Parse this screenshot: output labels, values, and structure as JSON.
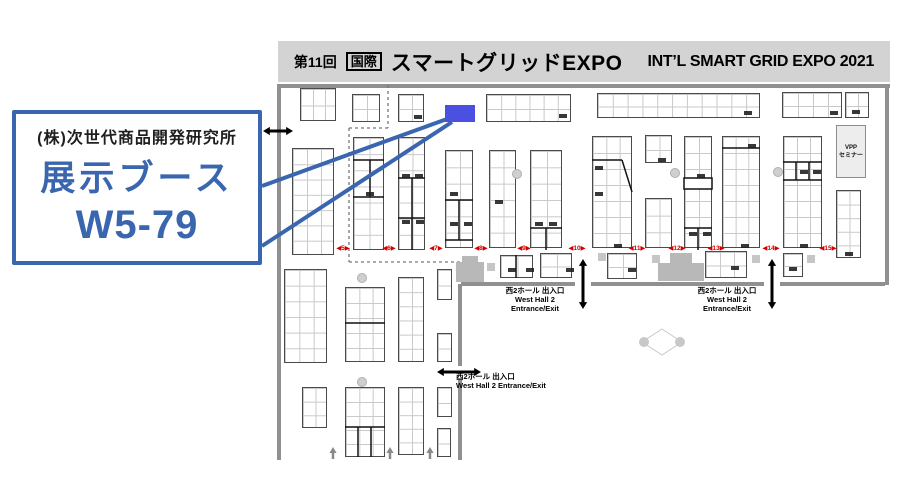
{
  "header": {
    "edition": "第11回",
    "kokusai": "国際",
    "title_jp": "スマートグリッドEXPO",
    "title_en": "INT’L SMART GRID EXPO 2021"
  },
  "callout": {
    "company": "(株)次世代商品開発研究所",
    "line1": "展示ブース",
    "booth_no": "W5-79",
    "accent": "#3a66b0"
  },
  "map": {
    "highlight_booth": {
      "name": "W5-79",
      "x": 445,
      "y": 105,
      "w": 30,
      "h": 17,
      "color": "#4b50e0"
    },
    "connector_color": "#3a66b0",
    "connectors": [
      [
        262,
        186,
        447,
        119
      ],
      [
        262,
        246,
        452,
        122
      ]
    ],
    "seminar_box": {
      "x": 836,
      "y": 125,
      "w": 30,
      "h": 53,
      "lines": [
        "VPP",
        "セミナー"
      ]
    },
    "entrances": [
      {
        "x": 493,
        "y": 286,
        "w": 84,
        "align": "center",
        "lines": [
          "西2ホール 出入口",
          "West Hall 2",
          "Entrance/Exit"
        ]
      },
      {
        "x": 685,
        "y": 286,
        "w": 84,
        "align": "center",
        "lines": [
          "西2ホール 出入口",
          "West Hall 2",
          "Entrance/Exit"
        ]
      },
      {
        "x": 456,
        "y": 372,
        "w": 150,
        "align": "left",
        "lines": [
          "西2ホール 出入口",
          "West Hall 2 Entrance/Exit"
        ]
      }
    ],
    "aisles": {
      "y": 244,
      "color": "#d40000",
      "items": [
        {
          "label": "◀5▶",
          "x": 343
        },
        {
          "label": "◀6▶",
          "x": 389
        },
        {
          "label": "◀7▶",
          "x": 436
        },
        {
          "label": "◀8▶",
          "x": 481
        },
        {
          "label": "◀9▶",
          "x": 524
        },
        {
          "label": "◀10▶",
          "x": 577
        },
        {
          "label": "◀11▶",
          "x": 637
        },
        {
          "label": "◀12▶",
          "x": 677
        },
        {
          "label": "◀13▶",
          "x": 716
        },
        {
          "label": "◀14▶",
          "x": 771
        },
        {
          "label": "◀15▶",
          "x": 828
        }
      ]
    },
    "booths": [
      [
        300,
        88,
        36,
        33,
        3,
        2
      ],
      [
        352,
        94,
        28,
        28,
        2,
        2
      ],
      [
        398,
        94,
        26,
        28,
        2,
        2
      ],
      [
        486,
        94,
        85,
        28,
        6,
        2
      ],
      [
        597,
        93,
        163,
        25,
        11,
        2
      ],
      [
        782,
        92,
        60,
        26,
        4,
        2
      ],
      [
        845,
        92,
        24,
        26,
        2,
        2
      ],
      [
        292,
        148,
        42,
        107,
        3,
        7
      ],
      [
        353,
        137,
        31,
        113,
        2,
        7
      ],
      [
        398,
        137,
        27,
        113,
        2,
        7
      ],
      [
        445,
        150,
        28,
        98,
        2,
        6
      ],
      [
        489,
        150,
        27,
        98,
        2,
        6
      ],
      [
        530,
        150,
        32,
        98,
        2,
        6
      ],
      [
        592,
        136,
        40,
        112,
        3,
        7
      ],
      [
        645,
        135,
        27,
        28,
        2,
        2
      ],
      [
        645,
        198,
        27,
        50,
        2,
        3
      ],
      [
        684,
        136,
        28,
        112,
        2,
        7
      ],
      [
        722,
        136,
        38,
        112,
        3,
        7
      ],
      [
        783,
        136,
        39,
        112,
        3,
        7
      ],
      [
        836,
        190,
        25,
        68,
        2,
        5
      ],
      [
        284,
        269,
        43,
        94,
        3,
        6
      ],
      [
        345,
        287,
        40,
        75,
        3,
        5
      ],
      [
        398,
        277,
        26,
        85,
        2,
        6
      ],
      [
        437,
        269,
        15,
        31,
        1,
        2
      ],
      [
        437,
        333,
        15,
        29,
        1,
        2
      ],
      [
        302,
        387,
        25,
        41,
        2,
        3
      ],
      [
        345,
        387,
        40,
        70,
        3,
        5
      ],
      [
        398,
        387,
        26,
        68,
        2,
        5
      ],
      [
        437,
        387,
        15,
        30,
        1,
        2
      ],
      [
        437,
        428,
        14,
        29,
        1,
        2
      ],
      [
        500,
        255,
        33,
        23,
        2,
        1
      ],
      [
        540,
        253,
        32,
        25,
        2,
        2
      ],
      [
        607,
        253,
        30,
        26,
        2,
        2
      ],
      [
        705,
        251,
        42,
        27,
        3,
        2
      ],
      [
        783,
        253,
        20,
        24,
        1,
        2
      ]
    ],
    "partitions": [
      [
        353,
        160,
        384,
        160
      ],
      [
        353,
        197,
        384,
        197
      ],
      [
        370,
        160,
        370,
        197
      ],
      [
        398,
        178,
        425,
        178
      ],
      [
        398,
        218,
        425,
        218
      ],
      [
        412,
        178,
        412,
        250
      ],
      [
        445,
        200,
        473,
        200
      ],
      [
        459,
        200,
        459,
        240
      ],
      [
        445,
        240,
        473,
        240
      ],
      [
        530,
        228,
        562,
        228
      ],
      [
        546,
        228,
        546,
        250
      ],
      [
        592,
        160,
        622,
        160
      ],
      [
        622,
        160,
        632,
        192
      ],
      [
        684,
        228,
        712,
        228
      ],
      [
        698,
        228,
        698,
        250
      ],
      [
        722,
        148,
        760,
        148
      ],
      [
        783,
        162,
        822,
        162
      ],
      [
        783,
        180,
        822,
        180
      ],
      [
        796,
        162,
        796,
        180
      ],
      [
        809,
        162,
        809,
        180
      ],
      [
        345,
        323,
        385,
        323
      ],
      [
        345,
        427,
        385,
        427
      ],
      [
        358,
        427,
        358,
        457
      ],
      [
        371,
        427,
        371,
        457
      ],
      [
        516,
        255,
        516,
        278
      ]
    ],
    "blackrects": [
      [
        684,
        178,
        28,
        11
      ]
    ],
    "walls": [
      [
        278,
        86,
        890,
        86
      ],
      [
        279,
        84,
        279,
        460
      ],
      [
        887,
        84,
        887,
        285
      ],
      [
        461,
        284,
        575,
        284
      ],
      [
        591,
        284,
        764,
        284
      ],
      [
        780,
        284,
        885,
        284
      ],
      [
        460,
        284,
        460,
        366
      ],
      [
        460,
        378,
        460,
        460
      ]
    ],
    "dashes": [
      [
        388,
        85,
        388,
        128
      ],
      [
        349,
        128,
        388,
        128
      ],
      [
        349,
        128,
        349,
        262
      ],
      [
        349,
        262,
        461,
        262
      ]
    ],
    "dbl_arrows": [
      [
        263,
        131,
        293,
        131
      ],
      [
        583,
        259,
        583,
        309
      ],
      [
        772,
        259,
        772,
        309
      ],
      [
        437,
        372,
        481,
        372
      ]
    ],
    "up_arrows": [
      [
        333,
        459,
        333,
        447
      ],
      [
        390,
        459,
        390,
        447
      ],
      [
        430,
        459,
        430,
        447
      ]
    ],
    "pillars_circle": [
      [
        517,
        174
      ],
      [
        675,
        173
      ],
      [
        778,
        172
      ],
      [
        362,
        278
      ],
      [
        362,
        382
      ]
    ],
    "pillars_square": [
      [
        487,
        263
      ],
      [
        598,
        253
      ],
      [
        652,
        255
      ],
      [
        752,
        255
      ],
      [
        807,
        255
      ]
    ],
    "gray_structures": [
      [
        456,
        262,
        28,
        20
      ],
      [
        462,
        256,
        16,
        7
      ],
      [
        658,
        263,
        46,
        18
      ],
      [
        670,
        253,
        22,
        11
      ]
    ],
    "diamond": {
      "cx": 662,
      "cy": 342,
      "rx": 20,
      "ry": 13
    },
    "tags": [
      [
        414,
        115
      ],
      [
        559,
        114
      ],
      [
        744,
        111
      ],
      [
        830,
        111
      ],
      [
        852,
        110
      ],
      [
        366,
        192
      ],
      [
        402,
        174
      ],
      [
        415,
        174
      ],
      [
        402,
        220
      ],
      [
        416,
        220
      ],
      [
        450,
        192
      ],
      [
        450,
        222
      ],
      [
        464,
        222
      ],
      [
        495,
        200
      ],
      [
        535,
        222
      ],
      [
        549,
        222
      ],
      [
        595,
        166
      ],
      [
        595,
        192
      ],
      [
        614,
        244
      ],
      [
        658,
        158
      ],
      [
        697,
        174
      ],
      [
        689,
        232
      ],
      [
        703,
        232
      ],
      [
        748,
        144
      ],
      [
        741,
        244
      ],
      [
        800,
        170
      ],
      [
        813,
        170
      ],
      [
        800,
        244
      ],
      [
        845,
        252
      ],
      [
        508,
        268
      ],
      [
        526,
        268
      ],
      [
        566,
        268
      ],
      [
        628,
        268
      ],
      [
        731,
        266
      ],
      [
        789,
        267
      ]
    ]
  }
}
